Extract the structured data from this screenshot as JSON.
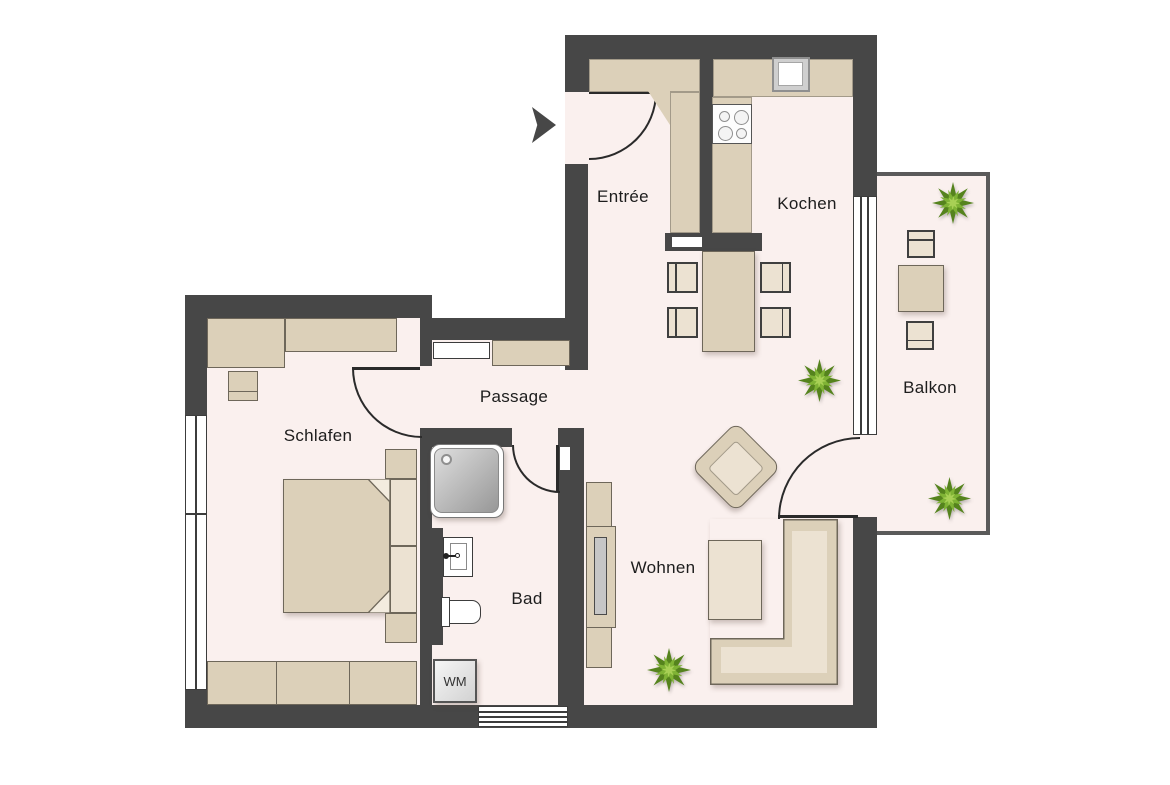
{
  "labels": {
    "entree": "Entrée",
    "kochen": "Kochen",
    "balkon": "Balkon",
    "passage": "Passage",
    "schlafen": "Schlafen",
    "bad": "Bad",
    "wohnen": "Wohnen",
    "wm": "WM"
  },
  "icons": {
    "entrance_arrow": "entrance-direction-arrow",
    "plant": "potted-plant"
  },
  "colors": {
    "wall": "#474747",
    "floor": "#faf0ee",
    "furn": "#dcd0b9",
    "furn-light": "#ece2d2",
    "outline": "#6e675a",
    "thin": "#a39a89",
    "stroke": "#2a2a2a",
    "frame": "#3c3c3c",
    "tv": "#c6c6c6",
    "text": "#1d1d1d",
    "plant-dark": "#55831d",
    "plant-mid": "#7fb335",
    "plant-light": "#a8d055",
    "shower-a": "#dedede",
    "shower-b": "#979797",
    "bal-wall": "#5a5a5a"
  }
}
